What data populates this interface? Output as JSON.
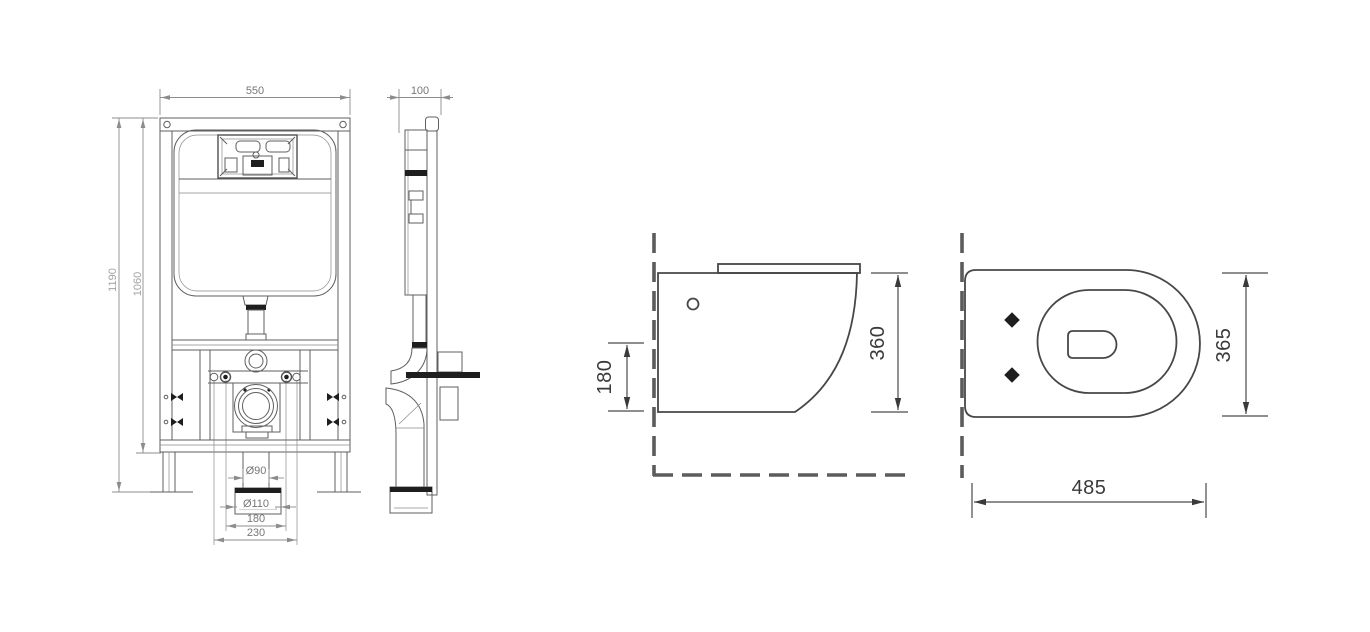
{
  "page": {
    "background": "#ffffff",
    "description": "Technical installation drawing: concealed cistern frame and wall-hung toilet pan with dimensions (mm)"
  },
  "colors": {
    "line": "#5f5f5f",
    "dark_fill": "#1e1e1e",
    "dim_text_small": "#767676",
    "dim_text_faint": "#a3a3a3",
    "dim_text_large": "#3a3a3a"
  },
  "views": {
    "frame_front": {
      "name": "Concealed cistern frame — front view",
      "dims": {
        "frame_width": "550",
        "total_height": "1190",
        "upper_height": "1060",
        "outlet_pipe_diameter": "Ø90",
        "outlet_socket_diameter": "Ø110",
        "fixing_bolt_spacing": "180",
        "outlet_spacing": "230"
      }
    },
    "frame_side": {
      "name": "Concealed cistern frame — side view",
      "dims": {
        "frame_depth": "100"
      }
    },
    "pan_side": {
      "name": "Wall-hung pan — side view",
      "dims": {
        "outlet_height": "180",
        "pan_height": "360"
      }
    },
    "pan_top": {
      "name": "Wall-hung pan — top view",
      "dims": {
        "pan_width": "365",
        "pan_length": "485"
      }
    }
  }
}
